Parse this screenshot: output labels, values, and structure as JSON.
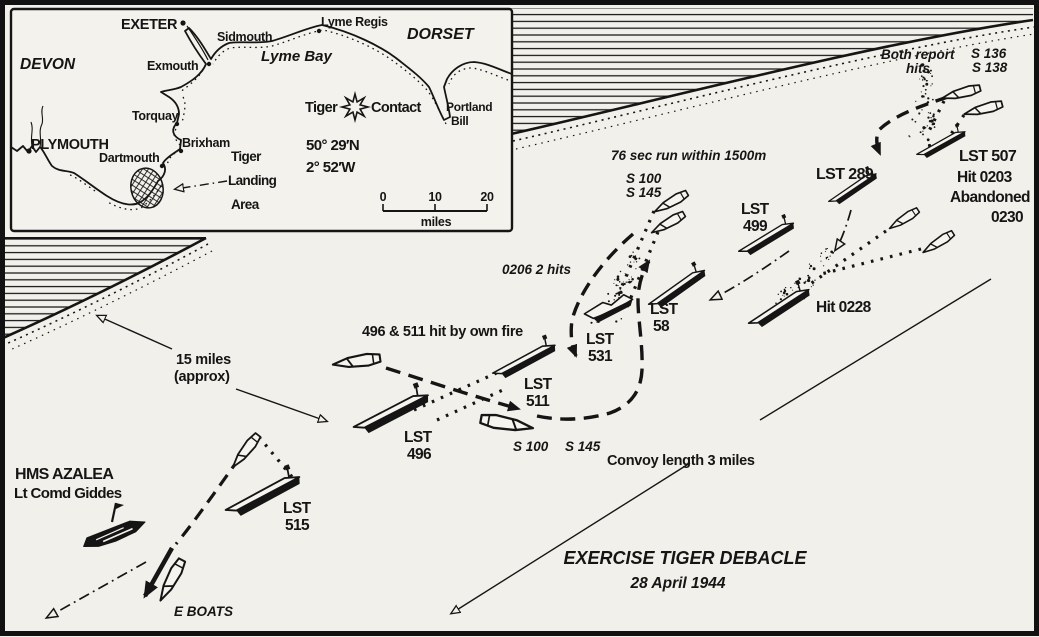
{
  "colors": {
    "ink": "#151515",
    "paper": "#f2f0ea"
  },
  "inset": {
    "devon": "DEVON",
    "dorset": "DORSET",
    "lyme_bay": "Lyme Bay",
    "exeter": "EXETER",
    "sidmouth": "Sidmouth",
    "lyme_regis": "Lyme Regis",
    "exmouth": "Exmouth",
    "torquay": "Torquay",
    "brixham": "Brixham",
    "plymouth": "PLYMOUTH",
    "dartmouth": "Dartmouth",
    "portland1": "Portland",
    "portland2": "Bill",
    "tiger": "Tiger",
    "contact": "Contact",
    "lat": "50° 29′N",
    "lon": "2° 52′W",
    "landing1": "Tiger",
    "landing2": "Landing",
    "landing3": "Area",
    "scale0": "0",
    "scale10": "10",
    "scale20": "20",
    "scale_unit": "miles"
  },
  "ships": {
    "lst507": {
      "name": "LST 507",
      "hit": "Hit 0203",
      "status": "Abandoned",
      "time": "0230"
    },
    "lst289": {
      "name": "LST 289"
    },
    "lst499": {
      "l1": "LST",
      "l2": "499"
    },
    "lst58": {
      "l1": "LST",
      "l2": "58"
    },
    "lst531": {
      "l1": "LST",
      "l2": "531"
    },
    "lst511": {
      "l1": "LST",
      "l2": "511"
    },
    "lst496": {
      "l1": "LST",
      "l2": "496"
    },
    "lst515": {
      "l1": "LST",
      "l2": "515"
    },
    "azalea": {
      "name": "HMS AZALEA",
      "cmdr": "Lt Comd Giddes"
    }
  },
  "notes": {
    "both1": "Both report",
    "both2": "hits",
    "s136": "S 136",
    "s138": "S 138",
    "hit0228": "Hit 0228",
    "run76": "76 sec run within 1500m",
    "s100a": "S 100",
    "s145a": "S 145",
    "hits0206": "0206  2 hits",
    "own_fire": "496 & 511 hit by own fire",
    "s100b": "S 100",
    "s145b": "S 145",
    "convoy": "Convoy length 3 miles",
    "miles1": "15 miles",
    "miles2": "(approx)",
    "eboats": "E BOATS",
    "title": "EXERCISE TIGER DEBACLE",
    "date": "28 April 1944"
  }
}
